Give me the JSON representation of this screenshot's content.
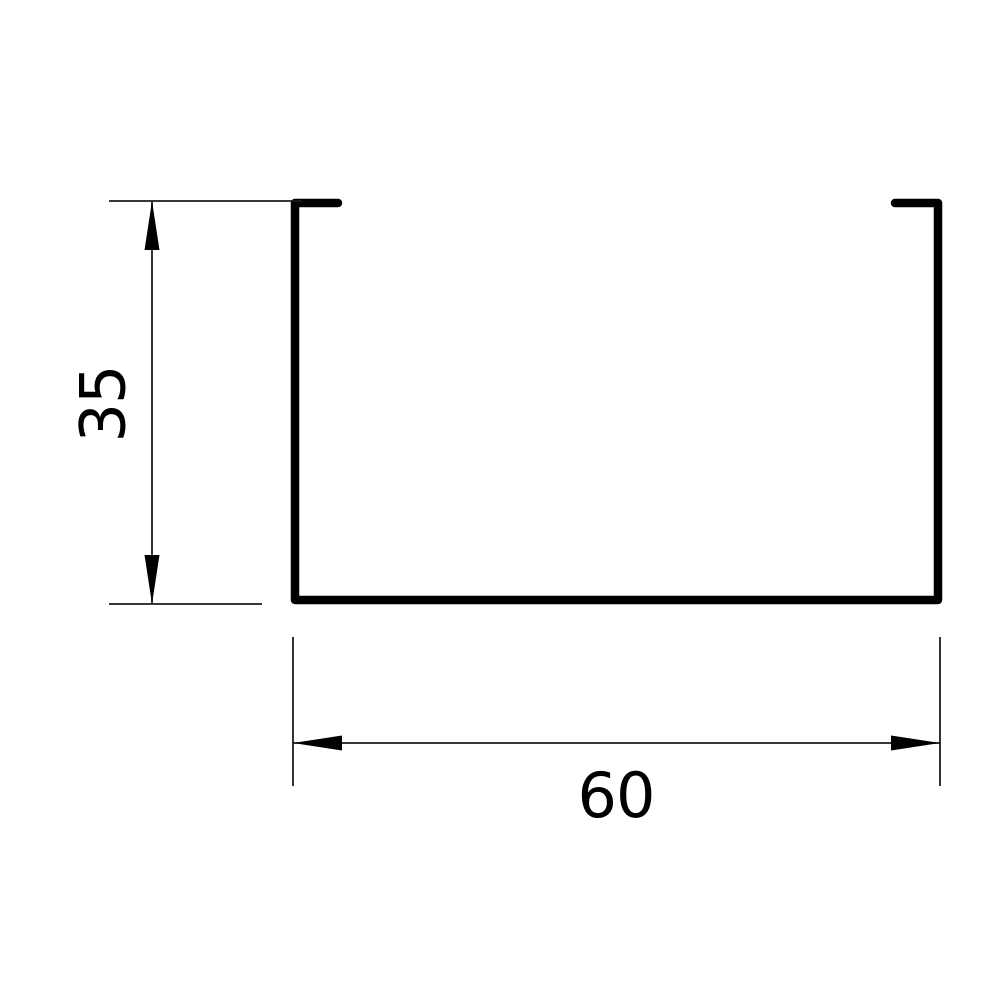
{
  "drawing": {
    "type": "technical-cross-section",
    "background_color": "#ffffff",
    "profile": {
      "shape": "u-channel-with-top-lips",
      "stroke_color": "#000000"
    },
    "dimension_style": {
      "thin_line_color": "#1c1c1c",
      "arrow_color": "#000000",
      "text_color": "#000000"
    },
    "dimensions": {
      "height": {
        "label": "35",
        "value": 35,
        "orientation": "vertical"
      },
      "width": {
        "label": "60",
        "value": 60,
        "orientation": "horizontal"
      }
    }
  }
}
